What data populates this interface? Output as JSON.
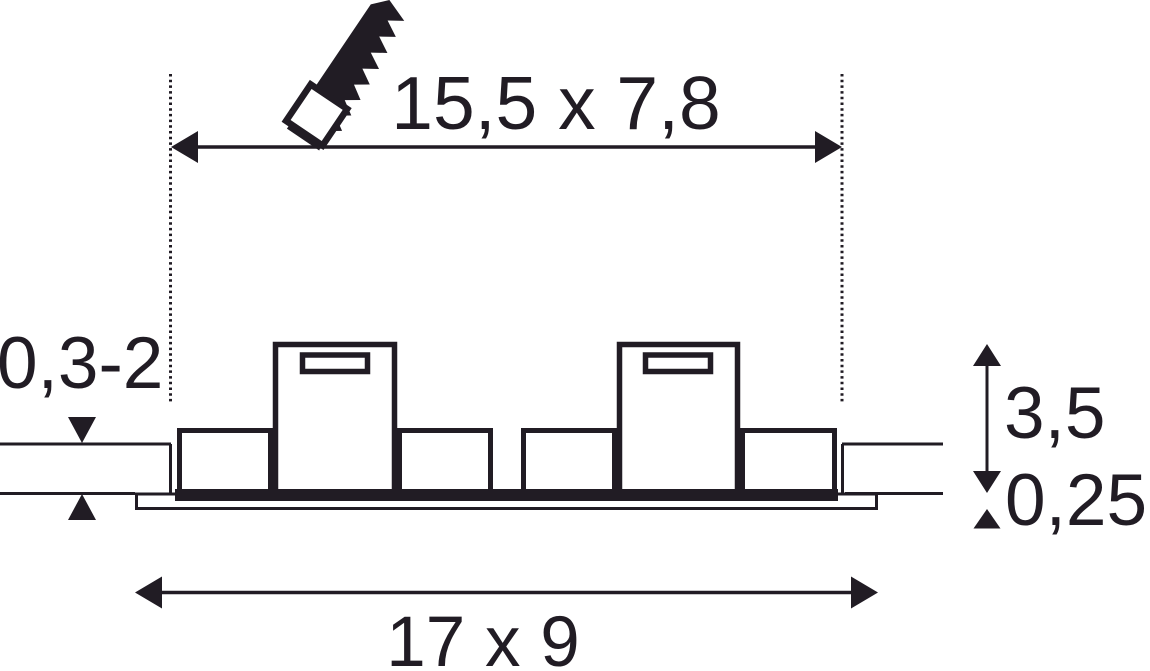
{
  "drawing": {
    "background_color": "#ffffff",
    "ink_color": "#211c24",
    "labels": {
      "cutout_size": "15,5 x 7,8",
      "ceiling_thickness_range": "0,3-2",
      "recess_height": "3,5",
      "frame_thickness": "0,25",
      "outer_size": "17 x 9"
    },
    "icons": [
      {
        "name": "saw-icon",
        "meaning": "ceiling cut-out"
      }
    ]
  }
}
